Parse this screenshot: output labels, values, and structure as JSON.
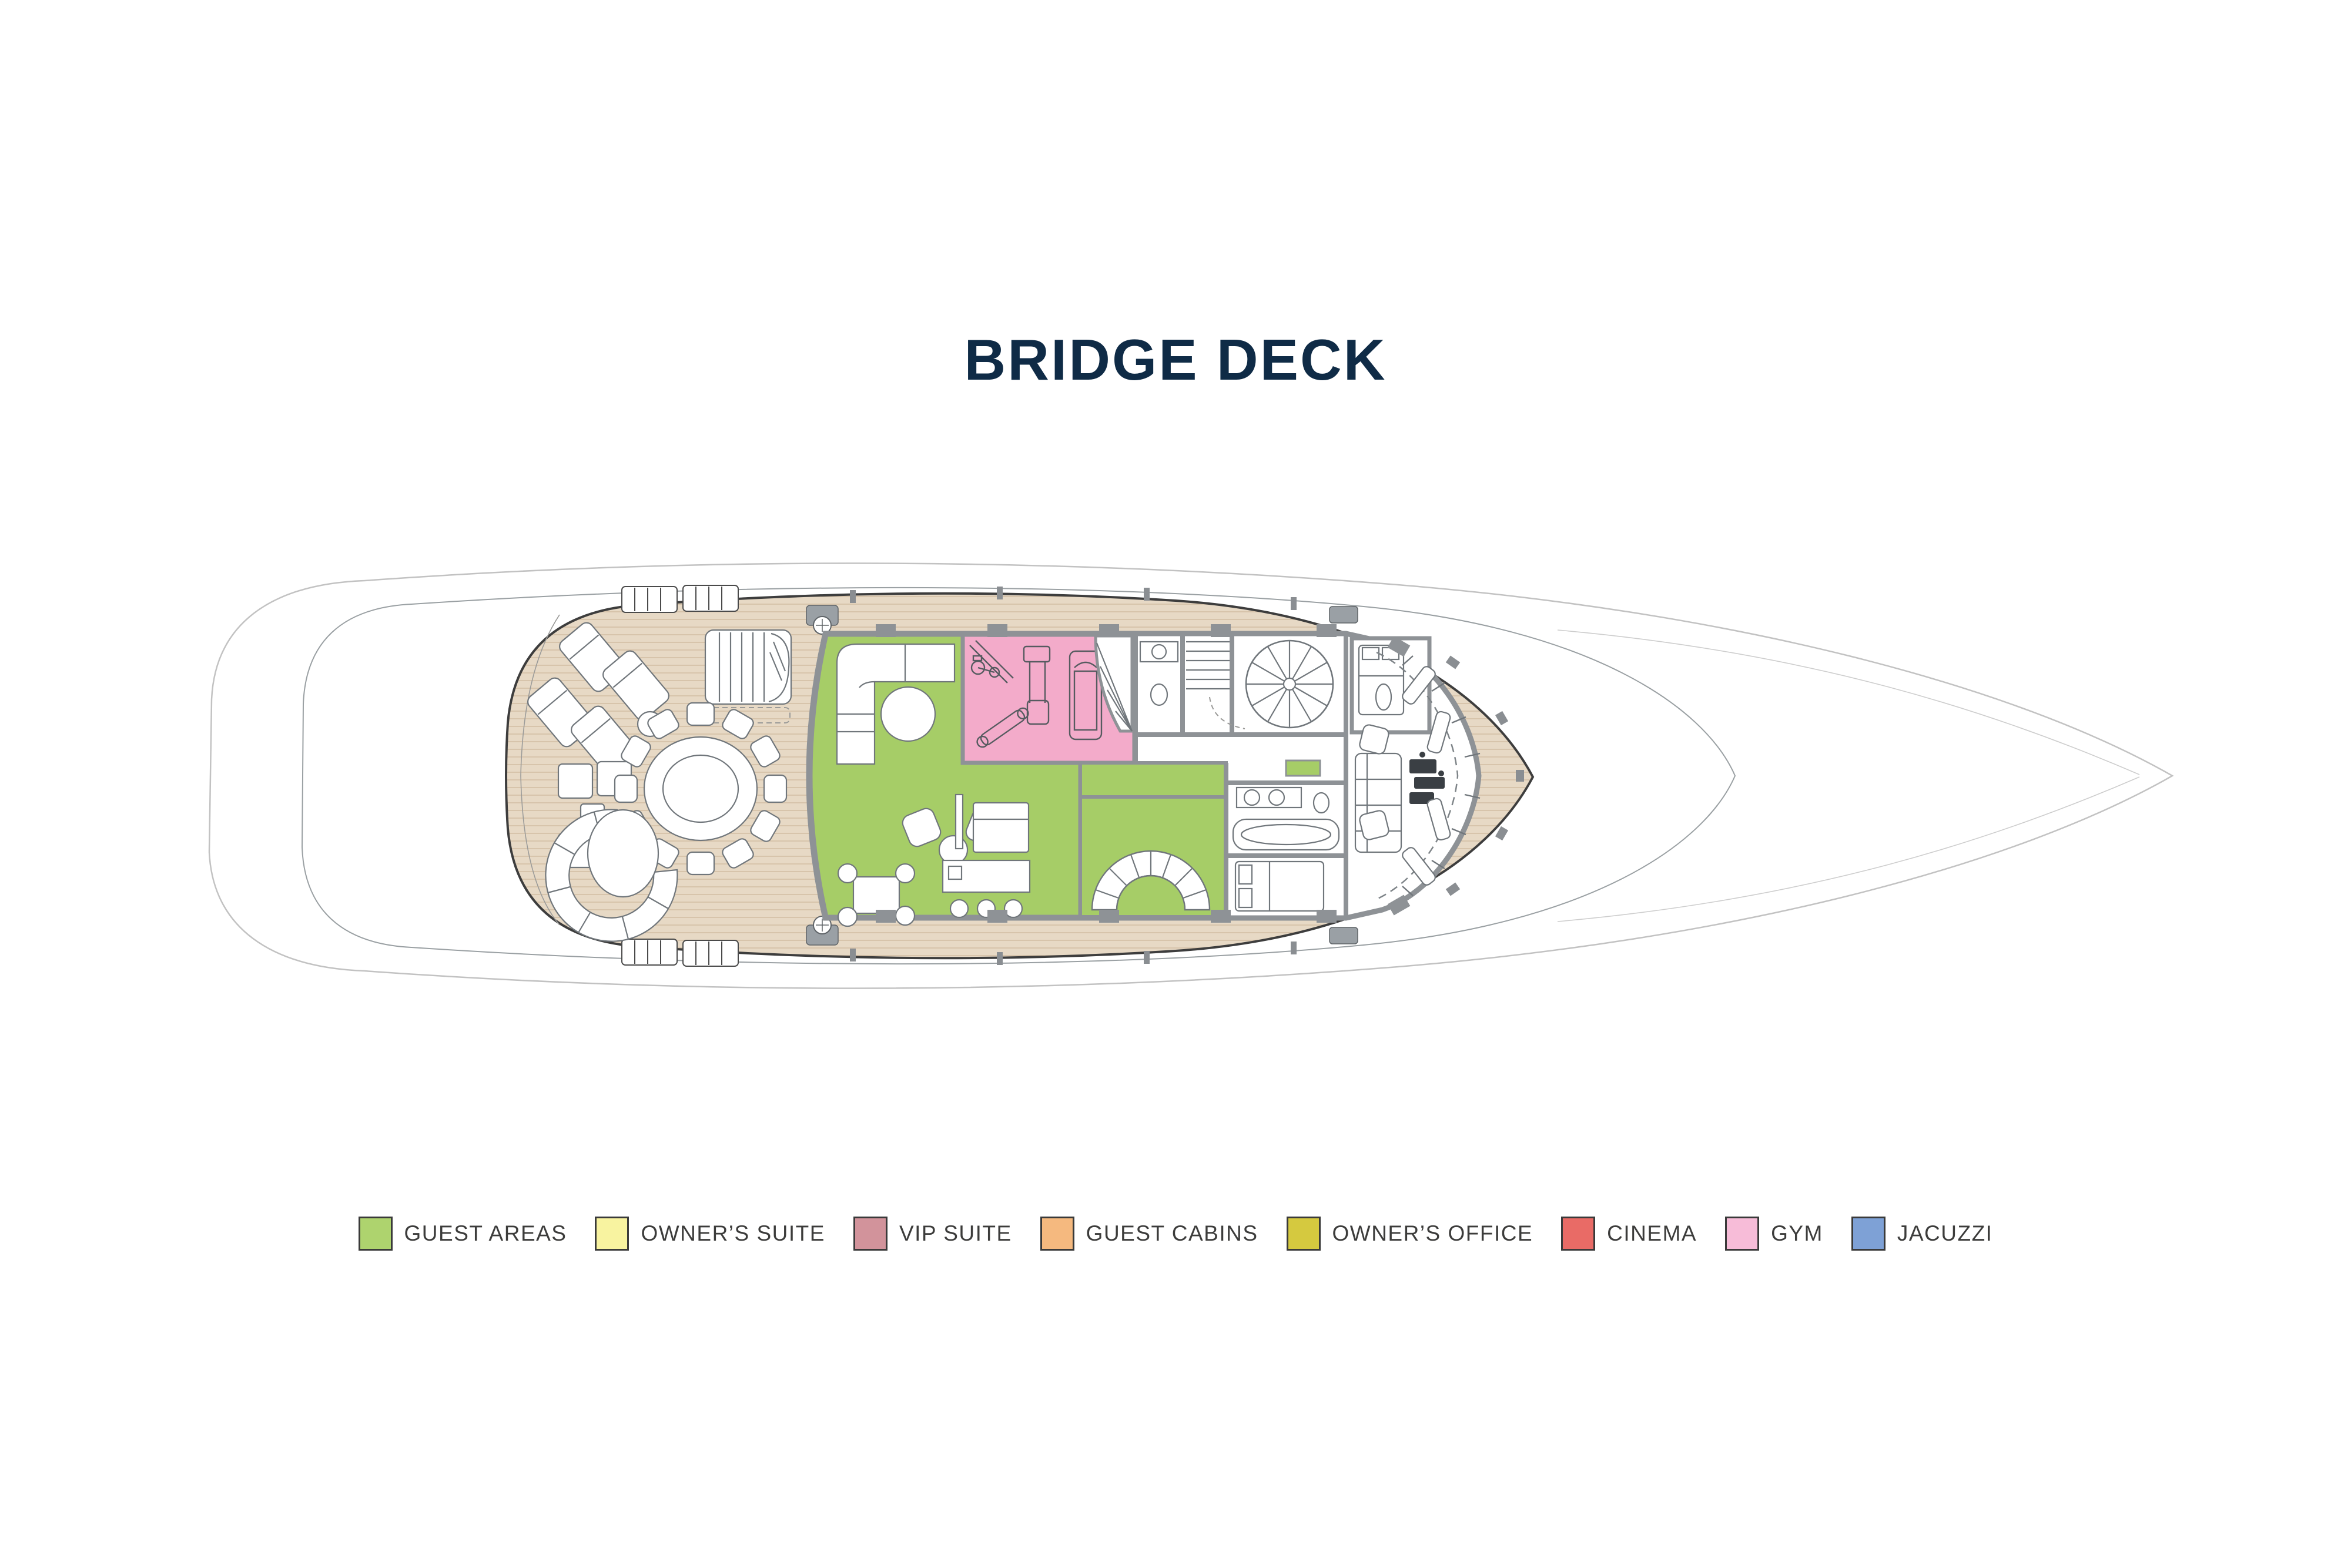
{
  "title": {
    "text": "BRIDGE DECK",
    "color": "#0f2b46"
  },
  "plan": {
    "name": "bridge-deck-floor-plan",
    "palette": {
      "hull_line": "#c2c2c2",
      "main_deck_line": "#8b8f92",
      "bulwark_line": "#3d3d3d",
      "deck_teak": "#e7d9c5",
      "deck_plank_line": "#d3bea4",
      "wall": "#8e9296",
      "room_white": "#ffffff",
      "furniture_line": "#70767b",
      "equipment_line": "#565b60",
      "guest_area_fill": "#a6cd67",
      "gym_fill": "#f3abca"
    }
  },
  "legend": {
    "swatch_border": "#3a3a3a",
    "label_color": "#3c3c3b",
    "items": [
      {
        "label": "GUEST AREAS",
        "color": "#aed36e"
      },
      {
        "label": "OWNER’S SUITE",
        "color": "#f8f3a0"
      },
      {
        "label": "VIP SUITE",
        "color": "#d2939b"
      },
      {
        "label": "GUEST CABINS",
        "color": "#f5b97f"
      },
      {
        "label": "OWNER’S OFFICE",
        "color": "#d5c93f"
      },
      {
        "label": "CINEMA",
        "color": "#e96b66"
      },
      {
        "label": "GYM",
        "color": "#f7bcd8"
      },
      {
        "label": "JACUZZI",
        "color": "#7ea1d6"
      }
    ]
  }
}
